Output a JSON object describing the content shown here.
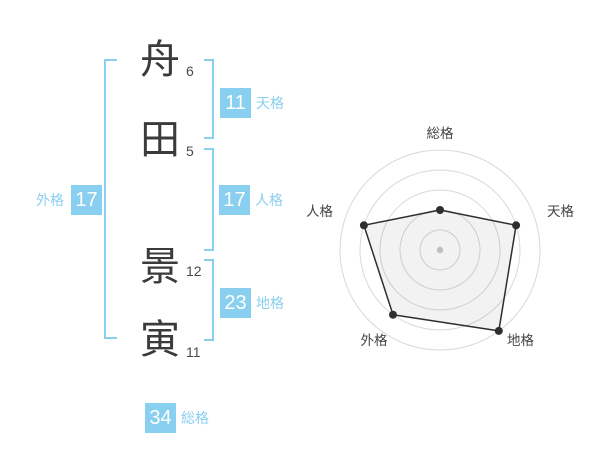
{
  "name": {
    "characters": [
      {
        "char": "舟",
        "strokes": "6"
      },
      {
        "char": "田",
        "strokes": "5"
      },
      {
        "char": "景",
        "strokes": "12"
      },
      {
        "char": "寅",
        "strokes": "11"
      }
    ]
  },
  "scores": [
    {
      "id": "tenkaku",
      "label": "天格",
      "value": "11"
    },
    {
      "id": "jinkaku",
      "label": "人格",
      "value": "17"
    },
    {
      "id": "chikaku",
      "label": "地格",
      "value": "23"
    },
    {
      "id": "gaikaku",
      "label": "外格",
      "value": "17"
    },
    {
      "id": "soukaku",
      "label": "総格",
      "value": "34"
    }
  ],
  "colors": {
    "accent": "#89CFF0",
    "box_text": "#ffffff",
    "kanji": "#3b3b3b",
    "ring": "#d9d9d9",
    "radar_line": "#2e2e2e",
    "radar_fill": "rgba(0,0,0,0.05)",
    "center_dot": "#bfbfbf",
    "axis_label": "#444444"
  },
  "chart_data": {
    "type": "radar",
    "title": "",
    "categories": [
      "総格",
      "天格",
      "地格",
      "外格",
      "人格"
    ],
    "values": [
      2,
      4,
      5,
      4,
      4
    ],
    "max": 5,
    "rings": 5,
    "angles_deg": [
      90,
      18,
      -54,
      -126,
      162
    ],
    "grid": "circular",
    "legend": "none"
  }
}
